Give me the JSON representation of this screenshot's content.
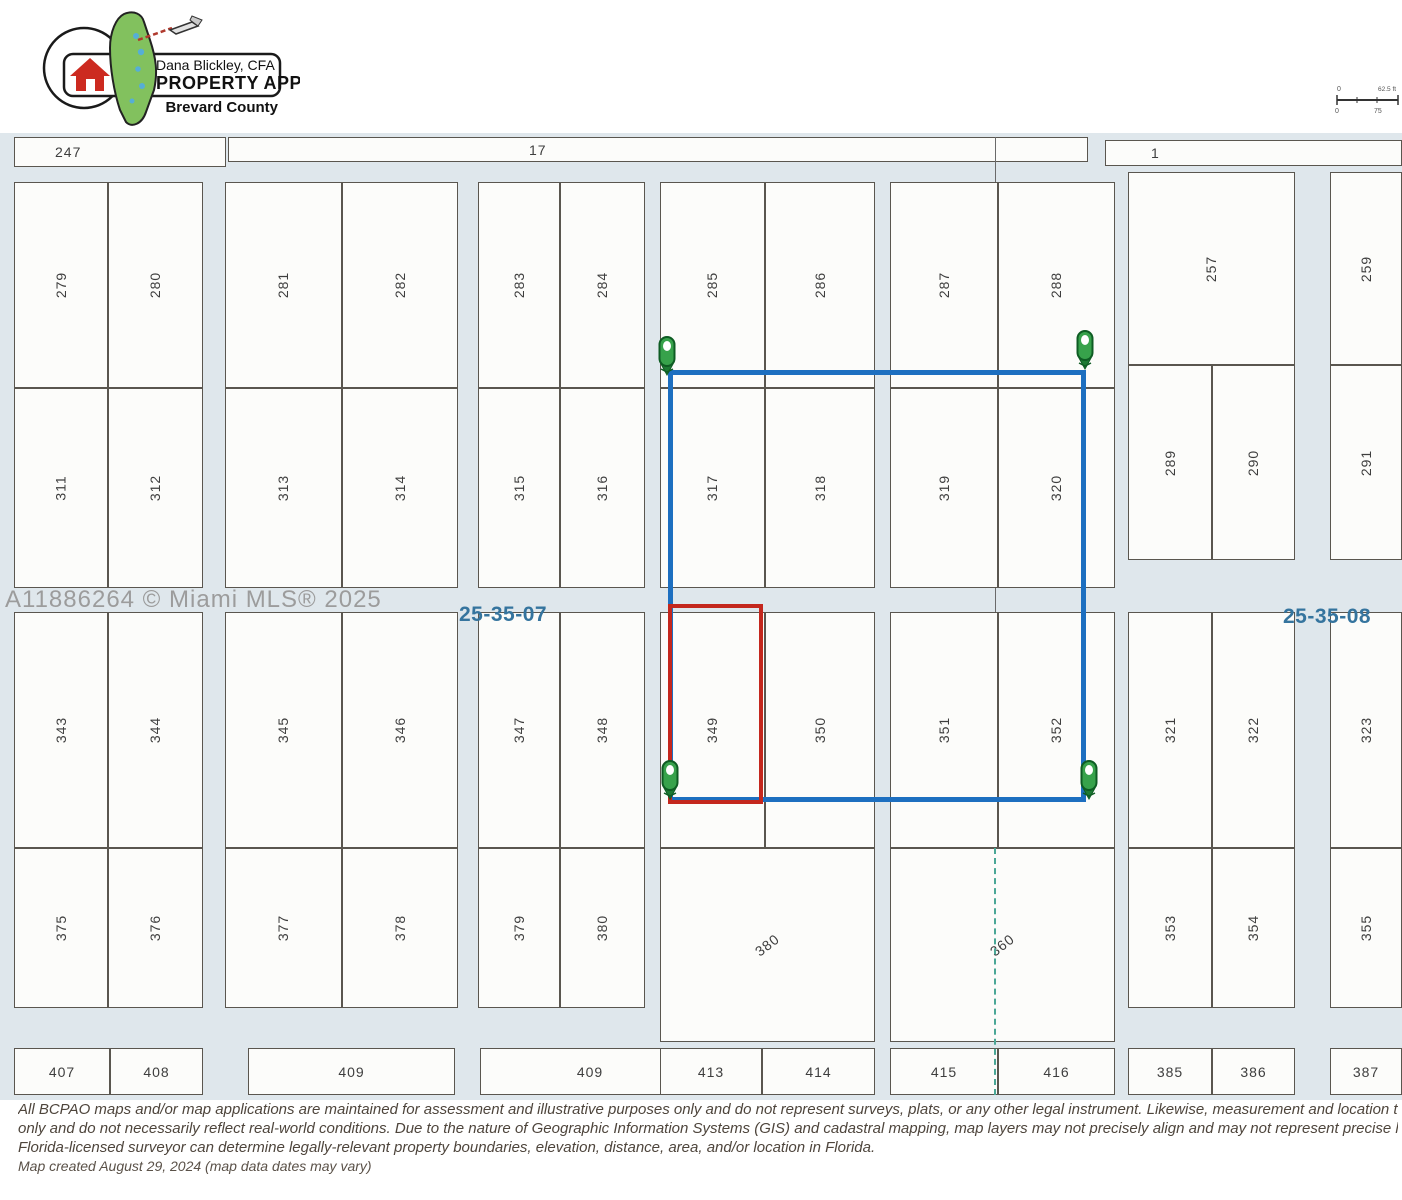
{
  "header": {
    "logo": {
      "line1": "Dana Blickley, CFA",
      "line2": "PROPERTY APPRAISER",
      "line3": "Brevard County"
    },
    "scale_bar": {
      "left_label": "0",
      "right_label": "62.5 ft",
      "bottom_left": "0",
      "bottom_mid": "75"
    }
  },
  "map": {
    "background_color": "#dfe7ec",
    "selection_color": "#1d6fc0",
    "highlight_color": "#c4271d",
    "section_line_color": "#4aa796",
    "watermark": "A11886264 © Miami MLS® 2025",
    "section_labels": [
      {
        "text": "25-35-07",
        "x": 459,
        "y": 603
      },
      {
        "text": "25-35-08",
        "x": 1283,
        "y": 605
      }
    ],
    "top_parcels": [
      {
        "n": "247",
        "x": 14,
        "y": 137,
        "w": 212,
        "h": 30,
        "r": "h",
        "pad": 40
      },
      {
        "n": "17",
        "x": 228,
        "y": 137,
        "w": 860,
        "h": 25,
        "r": "h",
        "pad": 300
      },
      {
        "n": "1",
        "x": 1105,
        "y": 140,
        "w": 297,
        "h": 26,
        "r": "h",
        "pad": 45
      }
    ],
    "lots": [
      {
        "n": "279",
        "x": 14,
        "y": 182,
        "w": 94,
        "h": 206
      },
      {
        "n": "280",
        "x": 108,
        "y": 182,
        "w": 95,
        "h": 206
      },
      {
        "n": "281",
        "x": 225,
        "y": 182,
        "w": 117,
        "h": 206
      },
      {
        "n": "282",
        "x": 342,
        "y": 182,
        "w": 116,
        "h": 206
      },
      {
        "n": "283",
        "x": 478,
        "y": 182,
        "w": 82,
        "h": 206
      },
      {
        "n": "284",
        "x": 560,
        "y": 182,
        "w": 85,
        "h": 206
      },
      {
        "n": "285",
        "x": 660,
        "y": 182,
        "w": 105,
        "h": 206
      },
      {
        "n": "286",
        "x": 765,
        "y": 182,
        "w": 110,
        "h": 206
      },
      {
        "n": "287",
        "x": 890,
        "y": 182,
        "w": 108,
        "h": 206
      },
      {
        "n": "288",
        "x": 998,
        "y": 182,
        "w": 117,
        "h": 206
      },
      {
        "n": "257",
        "x": 1128,
        "y": 172,
        "w": 167,
        "h": 193
      },
      {
        "n": "259",
        "x": 1330,
        "y": 172,
        "w": 72,
        "h": 193
      },
      {
        "n": "311",
        "x": 14,
        "y": 388,
        "w": 94,
        "h": 200
      },
      {
        "n": "312",
        "x": 108,
        "y": 388,
        "w": 95,
        "h": 200
      },
      {
        "n": "313",
        "x": 225,
        "y": 388,
        "w": 117,
        "h": 200
      },
      {
        "n": "314",
        "x": 342,
        "y": 388,
        "w": 116,
        "h": 200
      },
      {
        "n": "315",
        "x": 478,
        "y": 388,
        "w": 82,
        "h": 200
      },
      {
        "n": "316",
        "x": 560,
        "y": 388,
        "w": 85,
        "h": 200
      },
      {
        "n": "317",
        "x": 660,
        "y": 388,
        "w": 105,
        "h": 200
      },
      {
        "n": "318",
        "x": 765,
        "y": 388,
        "w": 110,
        "h": 200
      },
      {
        "n": "319",
        "x": 890,
        "y": 388,
        "w": 108,
        "h": 200
      },
      {
        "n": "320",
        "x": 998,
        "y": 388,
        "w": 117,
        "h": 200
      },
      {
        "n": "289",
        "x": 1128,
        "y": 365,
        "w": 84,
        "h": 195
      },
      {
        "n": "290",
        "x": 1212,
        "y": 365,
        "w": 83,
        "h": 195
      },
      {
        "n": "291",
        "x": 1330,
        "y": 365,
        "w": 72,
        "h": 195
      },
      {
        "n": "343",
        "x": 14,
        "y": 612,
        "w": 94,
        "h": 236
      },
      {
        "n": "344",
        "x": 108,
        "y": 612,
        "w": 95,
        "h": 236
      },
      {
        "n": "345",
        "x": 225,
        "y": 612,
        "w": 117,
        "h": 236
      },
      {
        "n": "346",
        "x": 342,
        "y": 612,
        "w": 116,
        "h": 236
      },
      {
        "n": "347",
        "x": 478,
        "y": 612,
        "w": 82,
        "h": 236
      },
      {
        "n": "348",
        "x": 560,
        "y": 612,
        "w": 85,
        "h": 236
      },
      {
        "n": "349",
        "x": 660,
        "y": 612,
        "w": 105,
        "h": 236
      },
      {
        "n": "350",
        "x": 765,
        "y": 612,
        "w": 110,
        "h": 236
      },
      {
        "n": "351",
        "x": 890,
        "y": 612,
        "w": 108,
        "h": 236
      },
      {
        "n": "352",
        "x": 998,
        "y": 612,
        "w": 117,
        "h": 236
      },
      {
        "n": "321",
        "x": 1128,
        "y": 612,
        "w": 84,
        "h": 236
      },
      {
        "n": "322",
        "x": 1212,
        "y": 612,
        "w": 83,
        "h": 236
      },
      {
        "n": "323",
        "x": 1330,
        "y": 612,
        "w": 72,
        "h": 236
      },
      {
        "n": "375",
        "x": 14,
        "y": 848,
        "w": 94,
        "h": 160
      },
      {
        "n": "376",
        "x": 108,
        "y": 848,
        "w": 95,
        "h": 160
      },
      {
        "n": "377",
        "x": 225,
        "y": 848,
        "w": 117,
        "h": 160
      },
      {
        "n": "378",
        "x": 342,
        "y": 848,
        "w": 116,
        "h": 160
      },
      {
        "n": "379",
        "x": 478,
        "y": 848,
        "w": 82,
        "h": 160
      },
      {
        "n": "380",
        "x": 560,
        "y": 848,
        "w": 85,
        "h": 160
      },
      {
        "n": "380",
        "x": 660,
        "y": 848,
        "w": 215,
        "h": 194,
        "r": "d"
      },
      {
        "n": "360",
        "x": 890,
        "y": 848,
        "w": 225,
        "h": 194,
        "r": "d"
      },
      {
        "n": "353",
        "x": 1128,
        "y": 848,
        "w": 84,
        "h": 160
      },
      {
        "n": "354",
        "x": 1212,
        "y": 848,
        "w": 83,
        "h": 160
      },
      {
        "n": "355",
        "x": 1330,
        "y": 848,
        "w": 72,
        "h": 160
      },
      {
        "n": "407",
        "x": 14,
        "y": 1048,
        "w": 96,
        "h": 47,
        "r": "h"
      },
      {
        "n": "408",
        "x": 110,
        "y": 1048,
        "w": 93,
        "h": 47,
        "r": "h"
      },
      {
        "n": "409",
        "x": 248,
        "y": 1048,
        "w": 207,
        "h": 47,
        "r": "h"
      },
      {
        "n": "409",
        "x": 480,
        "y": 1048,
        "w": 220,
        "h": 47,
        "r": "h"
      },
      {
        "n": "413",
        "x": 660,
        "y": 1048,
        "w": 102,
        "h": 47,
        "r": "h"
      },
      {
        "n": "414",
        "x": 762,
        "y": 1048,
        "w": 113,
        "h": 47,
        "r": "h"
      },
      {
        "n": "415",
        "x": 890,
        "y": 1048,
        "w": 108,
        "h": 47,
        "r": "h"
      },
      {
        "n": "416",
        "x": 998,
        "y": 1048,
        "w": 117,
        "h": 47,
        "r": "h"
      },
      {
        "n": "385",
        "x": 1128,
        "y": 1048,
        "w": 84,
        "h": 47,
        "r": "h"
      },
      {
        "n": "386",
        "x": 1212,
        "y": 1048,
        "w": 83,
        "h": 47,
        "r": "h"
      },
      {
        "n": "387",
        "x": 1330,
        "y": 1048,
        "w": 72,
        "h": 47,
        "r": "h"
      }
    ],
    "selection_rect": {
      "x": 668,
      "y": 370,
      "w": 418,
      "h": 432
    },
    "highlight_rect": {
      "x": 668,
      "y": 604,
      "w": 95,
      "h": 200
    },
    "pins": [
      {
        "x": 656,
        "y": 336
      },
      {
        "x": 1074,
        "y": 330
      },
      {
        "x": 659,
        "y": 760
      },
      {
        "x": 1078,
        "y": 760
      }
    ]
  },
  "footer": {
    "disclaimer_lines": [
      "All BCPAO maps and/or map applications are maintained for assessment and illustrative purposes only and do not represent surveys, plats, or any other legal instrument. Likewise, measurement and location tools are t",
      "only and do not necessarily reflect real-world conditions. Due to the nature of Geographic Information Systems (GIS) and cadastral mapping, map layers may not precisely align and may not represent precise location, a",
      "Florida-licensed surveyor can determine legally-relevant property boundaries, elevation, distance, area, and/or location in Florida."
    ],
    "created": "Map created August 29, 2024 (map data dates may vary)"
  }
}
